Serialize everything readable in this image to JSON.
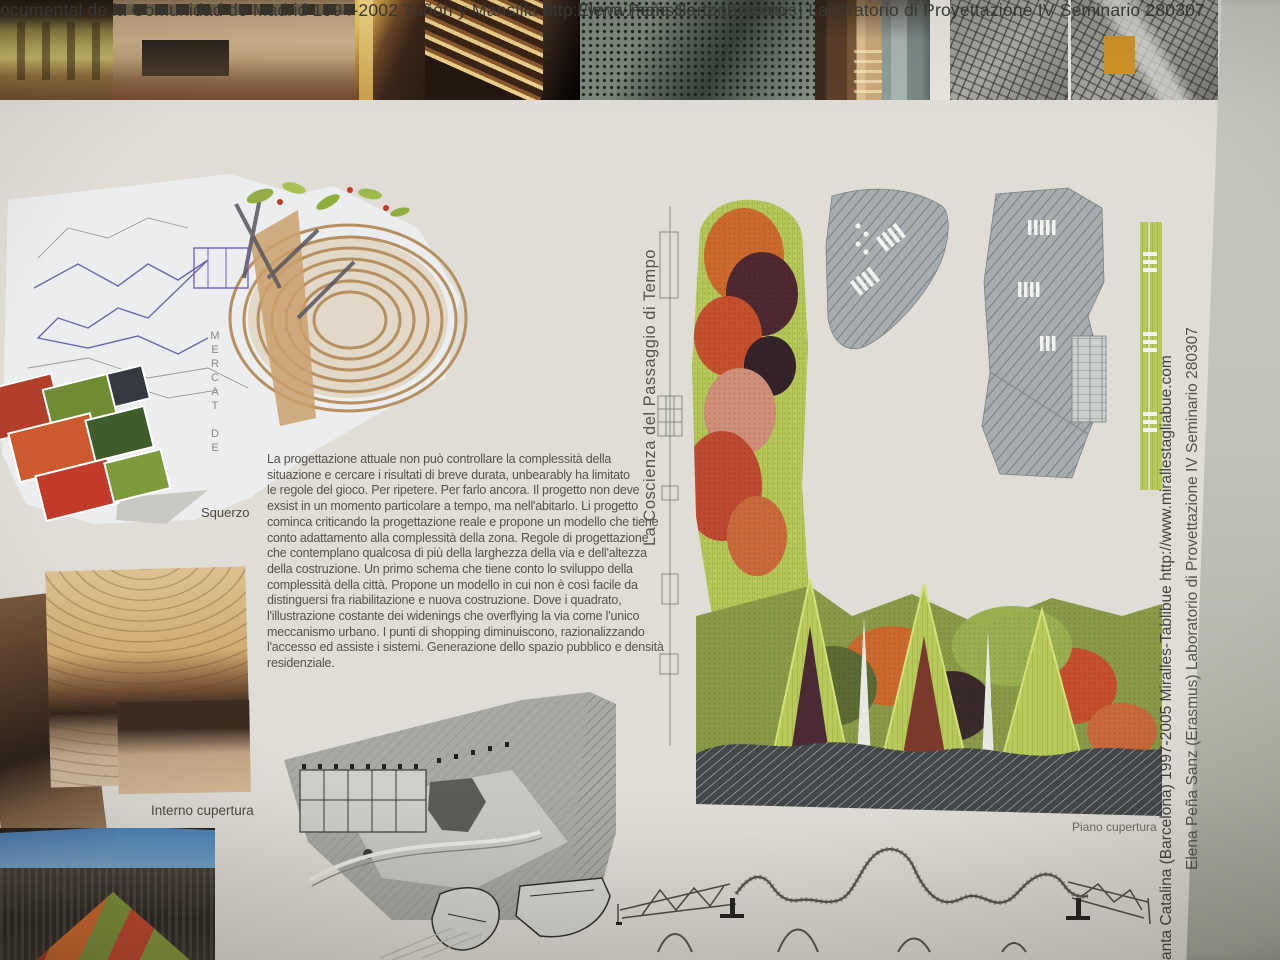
{
  "header": {
    "line1": "ocumental de la Comunidad de Madrid  1994-2002  Tuñón y Mansilla   http://www.mansilla-tunon.com",
    "line2": "Elena Peña Sanz  (Erasmus)  Laboratorio di Proyettazione IV   Seminario 280307"
  },
  "essay": {
    "text": "La progettazione attuale non può controllare la complessità della\nsituazione e cercare i risultati di breve durata, unbearably ha limitato\nle regole del gioco. Per ripetere. Per farlo ancora. Il progetto non deve\nexsist in un momento particolare a tempo, ma nell'abitarlo. Li progetto\ncominca criticando la progettazione reale e propone un modello che tiene\nconto adattamento alla complessità della zona. Regole di progettazione\nche contemplano qualcosa di più della larghezza della via e dell'altezza\ndella costruzione. Un primo schema che tiene conto lo sviluppo della\ncomplessità della città. Propone un modello in cui non è così facile da\ndistinguersi fra riabilitazione e nuova costruzione. Dove i quadrato,\nl'illustrazione costante dei widenings che overflying la via come l'unico\nmeccanismo urbano. I punti di shopping diminuiscono, razionalizzando\nl'accesso ed assiste i sistemi. Generazione dello spazio pubblico e densità\nresidenziale."
  },
  "captions": {
    "squerzo": "Squerzo",
    "interno_cupertura": "Interno cupertura",
    "piano_cupertura": "Piano cupertura",
    "mercat": "MERCAT DE"
  },
  "vertical_text": {
    "left_caption": "La  Coscienza  del  Passaggio  di  Tempo",
    "right_project": "anta Catalina (Barcelona) 1997-2005   Miralles-Tablibue   http://www.mirallestagliabue.com",
    "right_author": "Elena Peña Sanz  (Erasmus)  Laboratorio di Provettazione IV   Seminario 280307"
  },
  "colors": {
    "poster_bg": "#dfddd5",
    "roof_lime": "#b7c95a",
    "roof_orange": "#cc6a2e",
    "roof_red": "#c4502e",
    "roof_maroon": "#4f2830",
    "aerial_highlight": "#d19428",
    "backdrop": "#c2c4ba"
  }
}
